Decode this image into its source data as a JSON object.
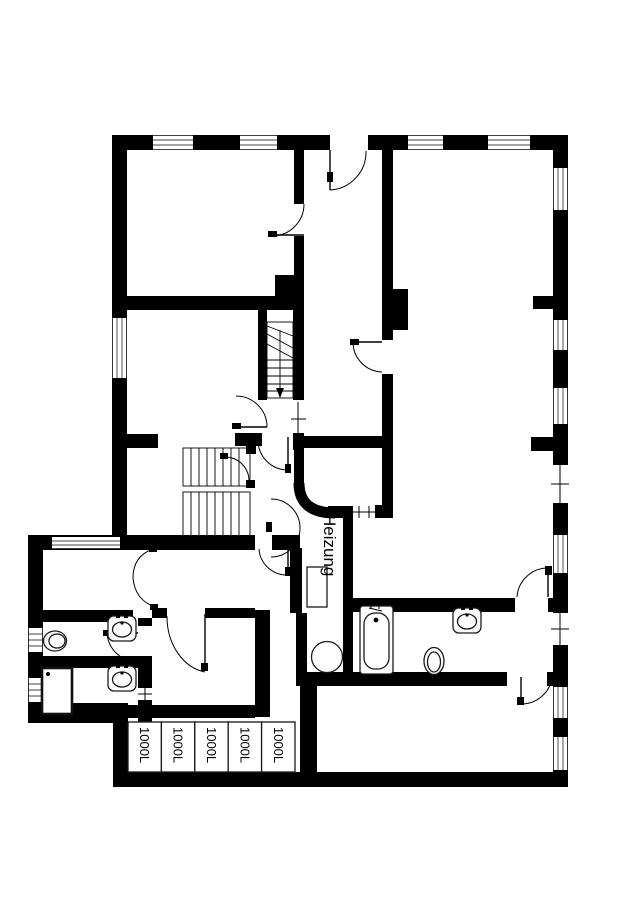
{
  "plan": {
    "labels": {
      "heating_room": "Heizung"
    },
    "tanks": [
      {
        "label": "1000L"
      },
      {
        "label": "1000L"
      },
      {
        "label": "1000L"
      },
      {
        "label": "1000L"
      },
      {
        "label": "1000L"
      }
    ],
    "colors": {
      "wall": "#000000",
      "background": "#ffffff"
    },
    "fixtures": [
      "staircase-upper",
      "staircase-lower",
      "bathtub",
      "sink",
      "toilet",
      "shower-tray",
      "boiler",
      "oil-drum",
      "storage-tank-row"
    ]
  }
}
